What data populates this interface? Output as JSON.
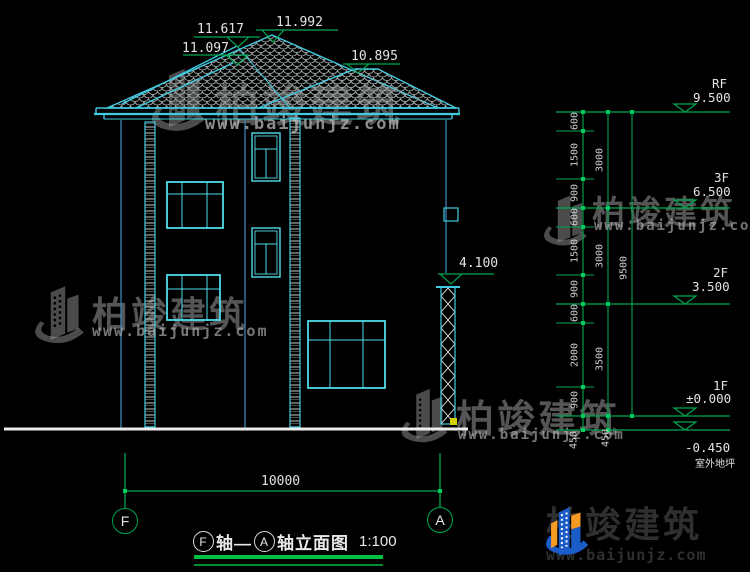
{
  "drawing": {
    "roof_levels": {
      "peak": "11.992",
      "left_ridge": "11.617",
      "left_lower_ridge": "11.097",
      "right_ridge": "10.895",
      "canopy_top": "4.100"
    },
    "floor_levels": [
      {
        "name": "RF",
        "value": "9.500"
      },
      {
        "name": "3F",
        "value": "6.500"
      },
      {
        "name": "2F",
        "value": "3.500"
      },
      {
        "name": "1F",
        "value": "±0.000"
      }
    ],
    "ground_level": {
      "value": "-0.450",
      "label": "室外地坪"
    },
    "dimensions": {
      "inner": [
        "600",
        "1500",
        "900",
        "600",
        "1500",
        "900",
        "600",
        "2000",
        "900",
        "450"
      ],
      "middle": [
        "3000",
        "3000",
        "3500",
        "450"
      ],
      "overall_height": "9500",
      "overall_width": "10000"
    },
    "axes": {
      "left": "F",
      "right": "A"
    },
    "title": {
      "axis_left": "F",
      "seg1": "轴—",
      "axis_right": "A",
      "seg2": "轴立面图",
      "scale": "1:100"
    }
  },
  "watermark": {
    "brand": "柏竣建筑",
    "url": "www.baijunjz.com"
  },
  "footer_logo": {
    "brand": "柏竣建筑",
    "url": "www.baijunjz.com"
  },
  "colors": {
    "line_cyan": "#41cbe0",
    "line_green": "#00a651",
    "wall_blue": "#3c86b4",
    "text_white": "#d9d9d9",
    "ground_white": "#ececec",
    "grip_yellow": "#d4d400",
    "logo_blue": "#1b5cc8",
    "logo_orange": "#f59a23"
  }
}
